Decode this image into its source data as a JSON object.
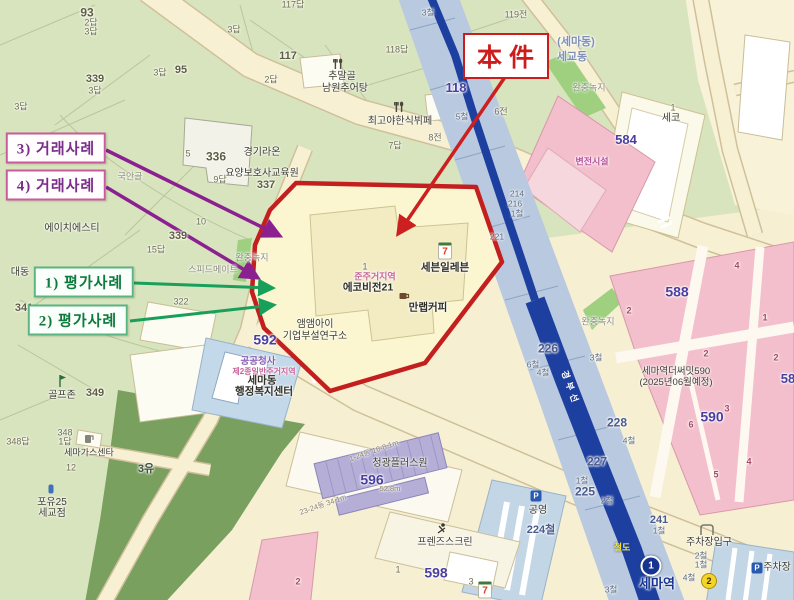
{
  "annotations": {
    "subject": "本件",
    "sale3": "3) 거래사례",
    "sale4": "4) 거래사례",
    "eval1": "1) 평가사례",
    "eval2": "2) 평가사례"
  },
  "districts": {
    "semadong": "(세마동)",
    "segyodong": "세교동"
  },
  "pois": {
    "chumalgol1": "추말골",
    "chumalgol2": "남원추어탕",
    "choigoya": "최고야한식뷔페",
    "raon1": "경기라온",
    "raon2": "요양보호사교육원",
    "gukangol": "국안골",
    "hst": "에이치에스티",
    "speedmate": "스피드메이트",
    "daedong": "대동",
    "zone_quasi": "준주거지역",
    "ecovision": "에코비전21",
    "seveneleven": "세븐일레븐",
    "manlab": "만랩커피",
    "mmai1": "앰앰아이",
    "mmai2": "기업부설연구소",
    "gongsa": "공공청사",
    "zone2": "제2종일반주거지역",
    "semadong_office1": "세마동",
    "semadong_office2": "행정복지센터",
    "byeonjeon": "변전시설",
    "seko": "세코",
    "golfzone": "골프존",
    "semagas": "세마가스센타",
    "poyou1": "포유25",
    "poyou2": "세교점",
    "chunggwang": "청광플러스원",
    "friends": "프렌즈스크린",
    "gongyoung": "공영",
    "parking_entrance": "주차장입구",
    "parking": "주차장",
    "thesummit1": "세마역더써밋590",
    "thesummit2": "(2025년06월예정)",
    "station": "세마역",
    "railroad": "철도",
    "rail_line": "경부선",
    "buffer1": "완충녹지",
    "buffer2": "완충녹지",
    "buffer3": "완충녹지"
  },
  "blocks": {
    "b584": "584",
    "b588": "588",
    "b590": "590",
    "b592": "592",
    "b596": "596",
    "b598": "598",
    "b118": "118",
    "b226": "226",
    "b225": "225",
    "b227": "227",
    "b228": "228",
    "b224": "224철",
    "b241": "241",
    "b58": "58"
  },
  "parcels": {
    "p117a": "117답",
    "p93": "93",
    "p2a": "2답",
    "p3a": "3답",
    "p3b": "3답",
    "p117": "117",
    "p95": "95",
    "p3c": "3답",
    "p2b": "2답",
    "p339a": "339",
    "p3d": "3답",
    "p3e": "3답",
    "p118a": "118답",
    "p119": "119전",
    "p6j": "6전",
    "p8j": "8전",
    "p7a": "7답",
    "p5b": "5",
    "p336": "336",
    "p9a": "9답",
    "p337": "337",
    "p10": "10",
    "p339b": "339",
    "p15a": "15답",
    "p341": "341",
    "p322": "322",
    "p1eco": "1",
    "p1seko": "1",
    "p348a": "348답",
    "p348": "348",
    "p1a": "1답",
    "p12": "12",
    "p349": "349",
    "p3yu": "3유",
    "p2pink": "2",
    "p1b": "1",
    "p3f": "3",
    "p5a": "5",
    "r3c1": "3철",
    "r5c": "5철",
    "r214": "214",
    "r216": "216",
    "r1c1": "1철",
    "r221": "221",
    "r3c2": "3철",
    "r6c": "6철",
    "r4c1": "4철",
    "r4c2": "4철",
    "r1c2": "1철",
    "r2c": "2철",
    "r1c3": "1철",
    "r3c3": "3철",
    "r4c3": "4철",
    "r2c2": "2철",
    "r1c4": "1철",
    "s2a": "2",
    "s4a": "4",
    "s1a": "1",
    "s2b": "2",
    "s2c": "2",
    "s3a": "3",
    "s6a": "6",
    "s4b": "4",
    "m52": "52.8m",
    "m124": "1-24동 16-8.1m",
    "m2324": "23-24동 34.1m"
  },
  "badges": {
    "line1": "1",
    "exit2": "2",
    "seven": "7",
    "parkP": "P"
  },
  "colors": {
    "subject_outline": "#c41f1f",
    "sale_arrow": "#8b2090",
    "eval_arrow": "#18a05a",
    "railway": "#1d3f9f",
    "rail_band": "#b9c9e0",
    "pink_block": "#f3bfcc",
    "road": "#f6efd2"
  }
}
